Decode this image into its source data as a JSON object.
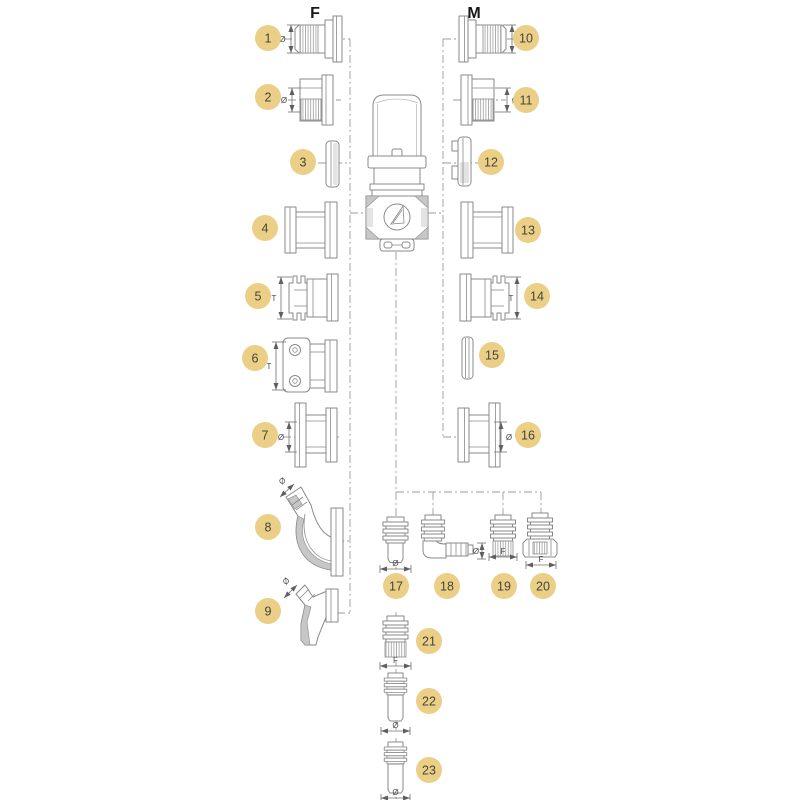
{
  "columns": {
    "female": "F",
    "male": "M"
  },
  "theme": {
    "badge_fill": "#ebcf87",
    "badge_text": "#45453c",
    "line": "#8a8a8a",
    "dash": "#9b9b9b",
    "dim": "#6f6f6f",
    "background": "#ffffff"
  },
  "parts": [
    {
      "number": "1",
      "dim": "Ø"
    },
    {
      "number": "2",
      "dim": "Ø"
    },
    {
      "number": "3",
      "dim": ""
    },
    {
      "number": "4",
      "dim": ""
    },
    {
      "number": "5",
      "dim": "T"
    },
    {
      "number": "6",
      "dim": "T"
    },
    {
      "number": "7",
      "dim": "Ø"
    },
    {
      "number": "8",
      "dim": "Ø"
    },
    {
      "number": "9",
      "dim": "Ø"
    },
    {
      "number": "10",
      "dim": "Ø"
    },
    {
      "number": "11",
      "dim": "Ø"
    },
    {
      "number": "12",
      "dim": ""
    },
    {
      "number": "13",
      "dim": ""
    },
    {
      "number": "14",
      "dim": "T"
    },
    {
      "number": "15",
      "dim": ""
    },
    {
      "number": "16",
      "dim": "Ø"
    },
    {
      "number": "17",
      "dim": "Ø"
    },
    {
      "number": "18",
      "dim": "Ø"
    },
    {
      "number": "19",
      "dim": "F"
    },
    {
      "number": "20",
      "dim": "F"
    },
    {
      "number": "21",
      "dim": "F"
    },
    {
      "number": "22",
      "dim": "Ø"
    },
    {
      "number": "23",
      "dim": "Ø"
    }
  ]
}
